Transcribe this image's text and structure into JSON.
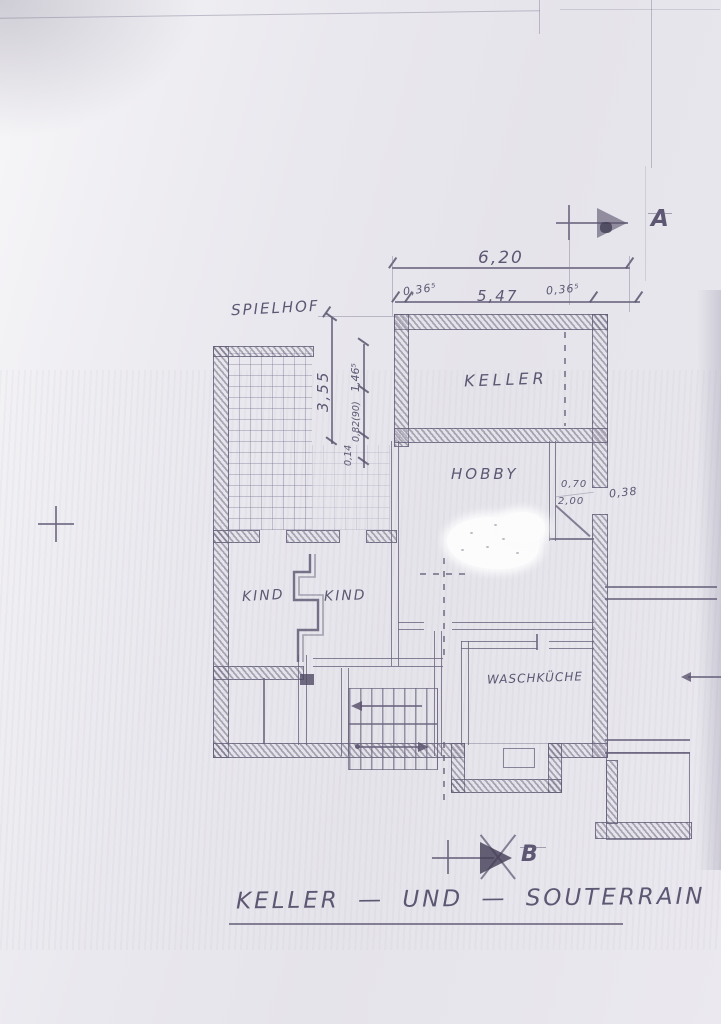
{
  "title": {
    "text": "KELLER — UND — SOUTERRAIN"
  },
  "rooms": {
    "spielhof": "SPIELHOF",
    "keller": "KELLER",
    "hobby": "HOBBY",
    "kind_left": "KIND",
    "kind_right": "KIND",
    "waschkueche": "WASCHKÜCHE"
  },
  "dims": {
    "overall_width": "6,20",
    "left_wall": "0,36⁵",
    "inner_width": "5,47",
    "right_wall": "0,36⁵",
    "courtyard_depth": "3,55",
    "v1": "1,46⁵",
    "v2": "0,82(90)",
    "v3": "0,14",
    "door_width": "0,70",
    "door_height": "2,00",
    "offset": "0,38"
  },
  "markers": {
    "section_a": "A",
    "section_b": "B"
  },
  "colors": {
    "paper": "#e9e8ee",
    "ink": "#68627c",
    "pencil": "#5d5773"
  }
}
